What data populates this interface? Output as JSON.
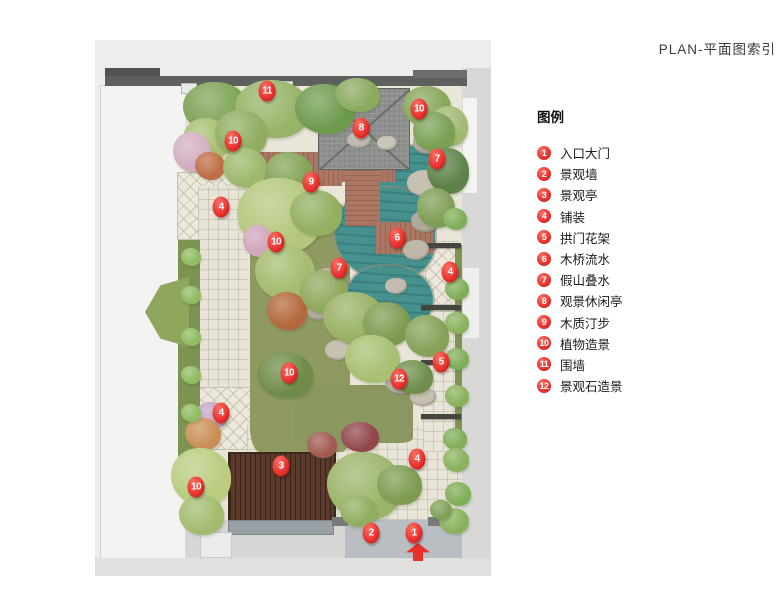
{
  "title": "PLAN-平面图索引",
  "legend": {
    "heading": "图例",
    "items": [
      {
        "num": "1",
        "label": "入口大门"
      },
      {
        "num": "2",
        "label": "景观墙"
      },
      {
        "num": "3",
        "label": "景观亭"
      },
      {
        "num": "4",
        "label": "铺装"
      },
      {
        "num": "5",
        "label": "拱门花架"
      },
      {
        "num": "6",
        "label": "木桥流水"
      },
      {
        "num": "7",
        "label": "假山叠水"
      },
      {
        "num": "8",
        "label": "观景休闲亭"
      },
      {
        "num": "9",
        "label": "木质汀步"
      },
      {
        "num": "10",
        "label": "植物造景"
      },
      {
        "num": "11",
        "label": "围墙"
      },
      {
        "num": "12",
        "label": "景观石造景"
      }
    ]
  },
  "plan": {
    "markers": [
      {
        "num": "11",
        "x": 172,
        "y": 51
      },
      {
        "num": "10",
        "x": 138,
        "y": 101
      },
      {
        "num": "8",
        "x": 266,
        "y": 88
      },
      {
        "num": "10",
        "x": 324,
        "y": 69
      },
      {
        "num": "7",
        "x": 342,
        "y": 119
      },
      {
        "num": "9",
        "x": 216,
        "y": 142
      },
      {
        "num": "4",
        "x": 126,
        "y": 167
      },
      {
        "num": "10",
        "x": 181,
        "y": 202
      },
      {
        "num": "6",
        "x": 302,
        "y": 198
      },
      {
        "num": "7",
        "x": 244,
        "y": 228
      },
      {
        "num": "4",
        "x": 355,
        "y": 232
      },
      {
        "num": "5",
        "x": 346,
        "y": 322
      },
      {
        "num": "12",
        "x": 304,
        "y": 339
      },
      {
        "num": "10",
        "x": 194,
        "y": 333
      },
      {
        "num": "4",
        "x": 126,
        "y": 373
      },
      {
        "num": "3",
        "x": 186,
        "y": 426
      },
      {
        "num": "10",
        "x": 101,
        "y": 447
      },
      {
        "num": "4",
        "x": 322,
        "y": 419
      },
      {
        "num": "2",
        "x": 276,
        "y": 493
      },
      {
        "num": "1",
        "x": 319,
        "y": 493
      }
    ],
    "colors": {
      "marker_red": "#e8312e",
      "water": "#46918e",
      "deck_wood": "#ab7663",
      "lawn": "#8e9a62",
      "pavilion_roof": "#8d908c",
      "dark_pavilion": "#5c3a2b",
      "paving": "#e9e5d8",
      "wall": "#5d605d"
    }
  }
}
